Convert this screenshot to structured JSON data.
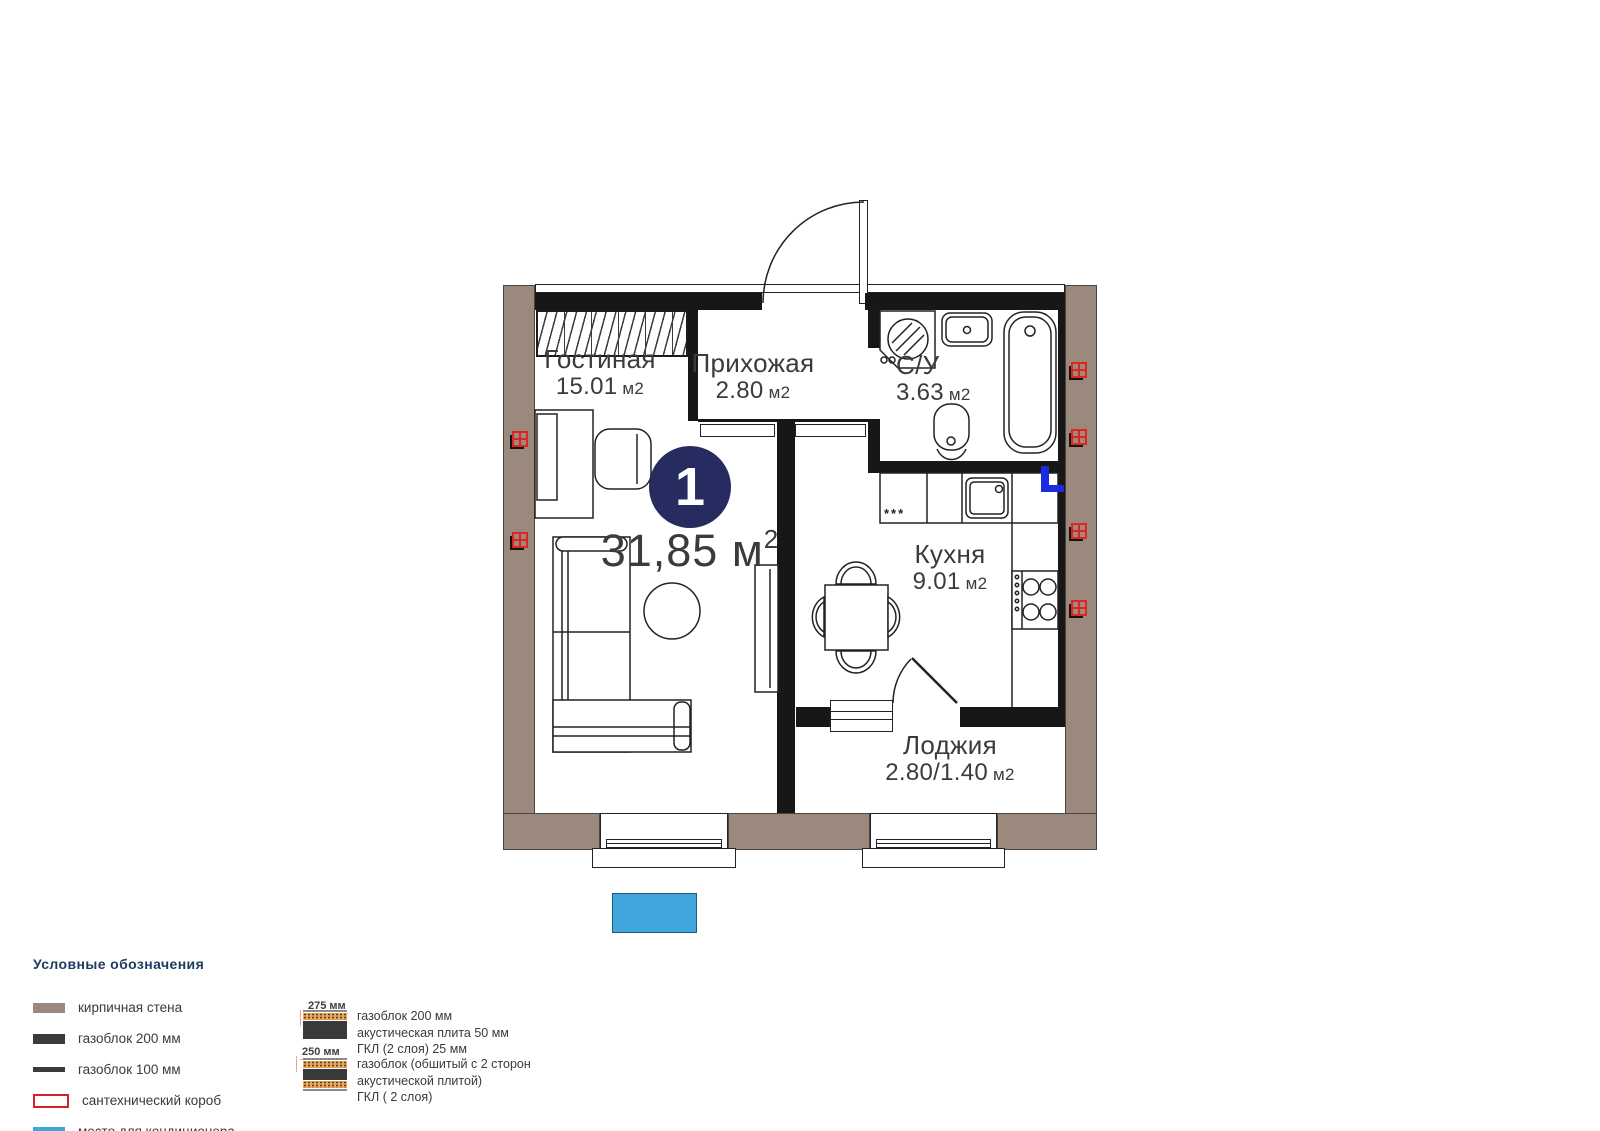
{
  "unit": {
    "number": "1",
    "area_value": "31,85",
    "area_unit": "м",
    "area_sup": "2"
  },
  "rooms": {
    "living": {
      "name": "Гостиная",
      "area": "15.01",
      "unit": "м2"
    },
    "hallway": {
      "name": "Прихожая",
      "area": "2.80",
      "unit": "м2"
    },
    "bathroom": {
      "name": "С/У",
      "area": "3.63",
      "unit": "м2"
    },
    "kitchen": {
      "name": "Кухня",
      "area": "9.01",
      "unit": "м2",
      "stars": "***"
    },
    "loggia": {
      "name": "Лоджия",
      "area": "2.80/1.40",
      "unit": "м2"
    }
  },
  "legend": {
    "title": "Условные обозначения",
    "items": [
      {
        "label": "кирпичная стена"
      },
      {
        "label": "газоблок 200 мм"
      },
      {
        "label": "газоблок 100 мм"
      },
      {
        "label": "сантехнический короб"
      },
      {
        "label": "место для кондиционера"
      }
    ],
    "wall_sections": [
      {
        "thickness": "275 мм",
        "line1": "газоблок 200 мм",
        "line2": "акустическая плита 50 мм",
        "line3": "ГКЛ (2 слоя) 25 мм"
      },
      {
        "thickness": "250 мм",
        "line1": "газоблок (обшитый с 2 сторон",
        "line2": "акустической плитой)",
        "line3": "ГКЛ ( 2 слоя)"
      }
    ]
  },
  "colors": {
    "brick": "#9a897c",
    "wall": "#171717",
    "unit_badge": "#262b60",
    "ac_place": "#41a6dc",
    "ac_marker": "#1c2be0",
    "plumbing_red": "#e0241f",
    "legend_title": "#1d3a5e"
  }
}
